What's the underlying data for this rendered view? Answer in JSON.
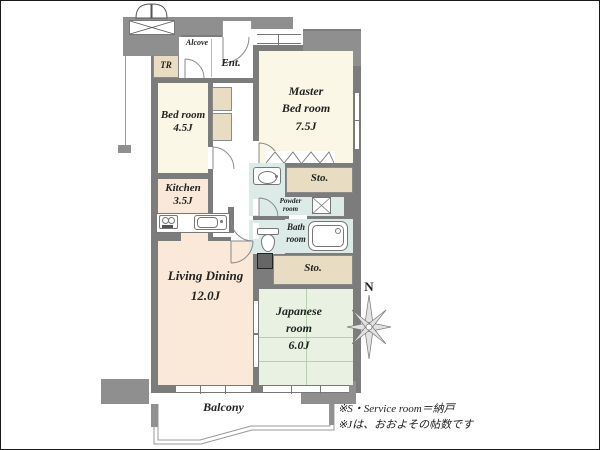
{
  "plan": {
    "common": {
      "alcove": "Alcove",
      "trunk_room": "TR",
      "entrance": "Ent.",
      "balcony": "Balcony"
    },
    "rooms": {
      "bedroom": {
        "l1": "Bed room",
        "l2": "4.5J"
      },
      "master": {
        "l1": "Master",
        "l2": "Bed room",
        "l3": "7.5J"
      },
      "kitchen": {
        "l1": "Kitchen",
        "l2": "3.5J"
      },
      "living": {
        "l1": "Living Dining",
        "l2": "12.0J"
      },
      "japanese": {
        "l1": "Japanese",
        "l2": "room",
        "l3": "6.0J"
      },
      "bath": {
        "l1": "Bath",
        "l2": "room"
      },
      "powder": {
        "l1": "Powder",
        "l2": "room"
      },
      "storage_upper": "Sto.",
      "storage_lower": "Sto."
    },
    "compass": {
      "north": "N"
    },
    "notes": {
      "l1": "※S・Service room＝納戸",
      "l2": "※Jは、おおよその帖数です"
    },
    "colors": {
      "wall": "#7c7c7c",
      "structure_block": "#8f8f8f",
      "bedroom_fill": "#faf7e6",
      "living_kitchen_fill": "#fae9d8",
      "japanese_fill": "#e9f2e2",
      "wet_area_fill": "#dcebe8",
      "storage_fill": "#e8dcc2",
      "tatami_line": "#b8cfae",
      "text": "#222222"
    }
  }
}
